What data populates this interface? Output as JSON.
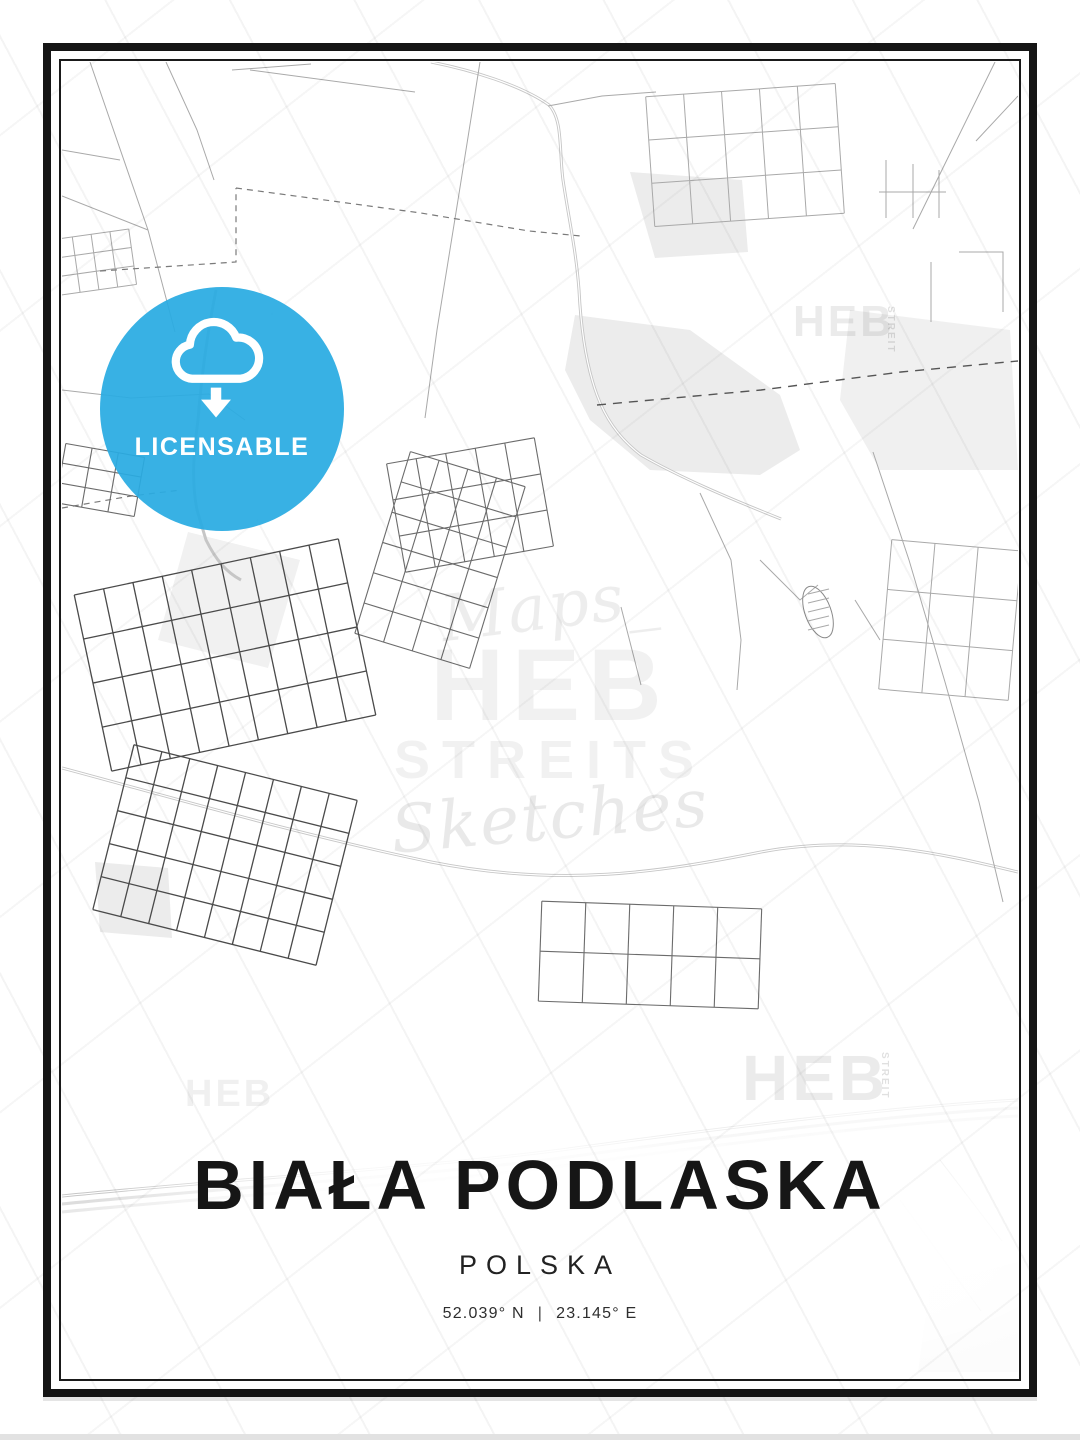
{
  "poster": {
    "title": "BIAŁA PODLASKA",
    "subtitle": "POLSKA",
    "coordinates": {
      "lat": "52.039° N",
      "separator": "|",
      "lon": "23.145° E"
    }
  },
  "badge": {
    "label": "LICENSABLE",
    "icon": "cloud-download-icon"
  },
  "watermarks": {
    "script_top": "Maps_",
    "block_top": "HEB",
    "block_bottom": "STREITS",
    "script_bottom": "Sketches",
    "corner_block": "HEB",
    "corner_side": "STREIT"
  },
  "colors": {
    "accent_blue": "#29ABE2",
    "frame_black": "#151515",
    "road_black": "#0c0c0c",
    "road_medium": "#4a4a4a",
    "road_light_gray": "#a9a9a9",
    "water_gray": "#c6c6c6",
    "shade_gray": "#ececec"
  }
}
